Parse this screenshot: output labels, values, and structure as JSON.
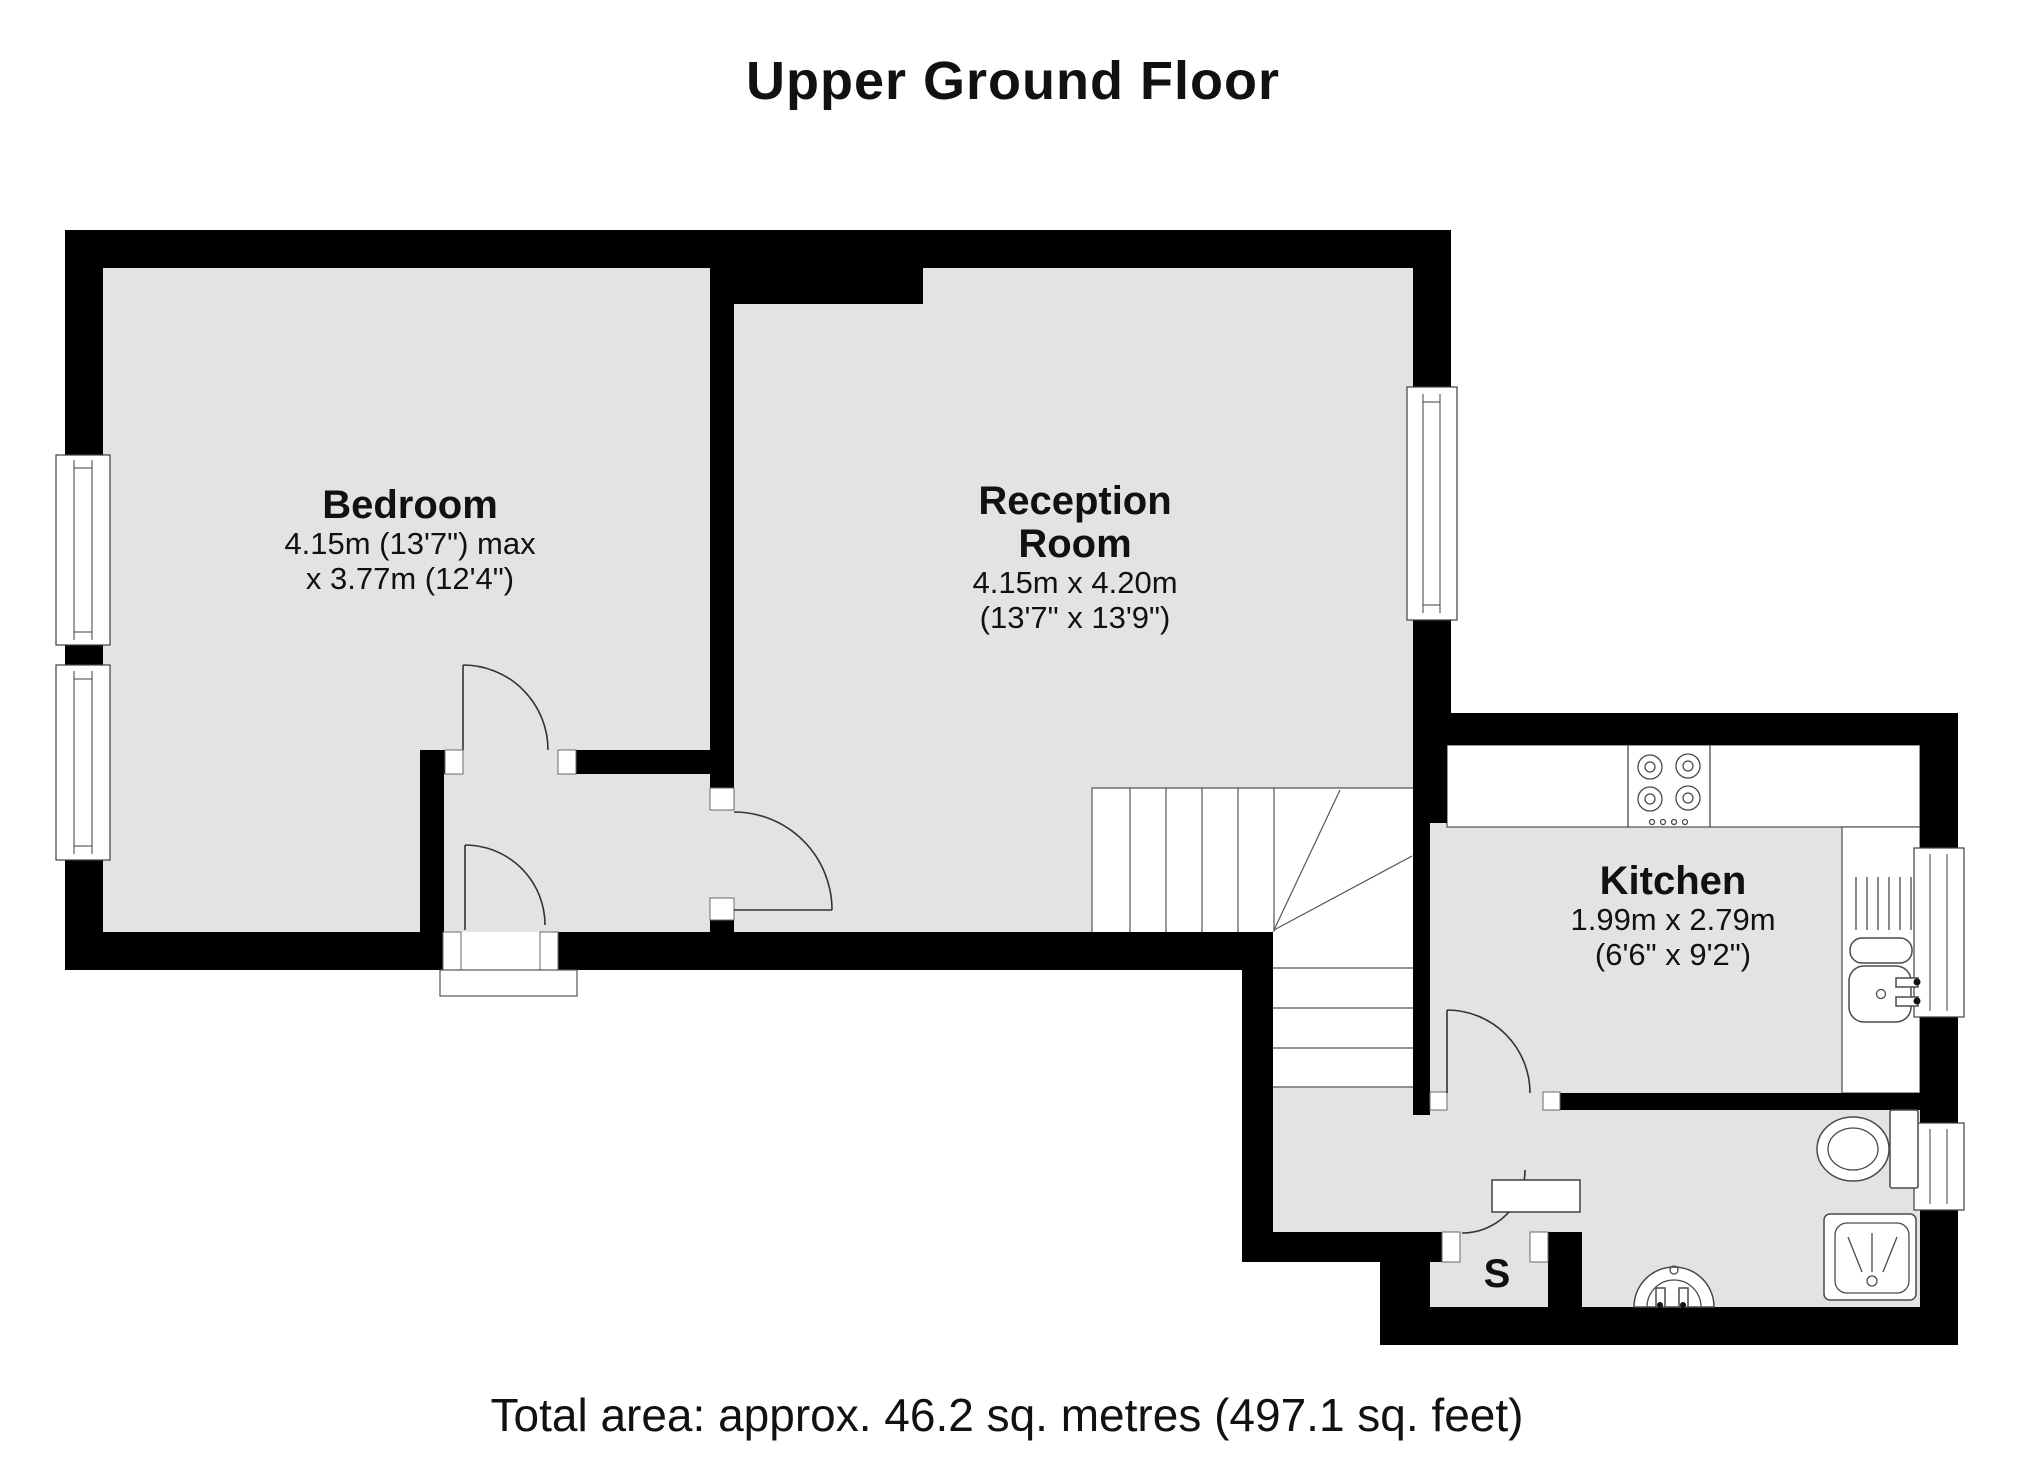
{
  "title": "Upper Ground Floor",
  "footer": {
    "total_area": "Total area: approx. 46.2 sq. metres (497.1 sq. feet)"
  },
  "rooms": [
    {
      "id": "bedroom",
      "name": "Bedroom",
      "dims_line1": "4.15m (13'7\") max",
      "dims_line2": "x 3.77m (12'4\")"
    },
    {
      "id": "reception",
      "name": "Reception Room",
      "dims_line1": "4.15m x 4.20m",
      "dims_line2": "(13'7\" x 13'9\")"
    },
    {
      "id": "kitchen",
      "name": "Kitchen",
      "dims_line1": "1.99m x 2.79m",
      "dims_line2": "(6'6\" x 9'2\")"
    },
    {
      "id": "storage",
      "name": "S"
    }
  ],
  "fixtures": [
    "stairs",
    "hob",
    "sink-drainer",
    "toilet",
    "shower",
    "basin"
  ],
  "colors": {
    "floor": "#e3e3e3",
    "wall": "#000000",
    "outline": "#4a4a4a",
    "background": "#ffffff",
    "text": "#111111"
  }
}
